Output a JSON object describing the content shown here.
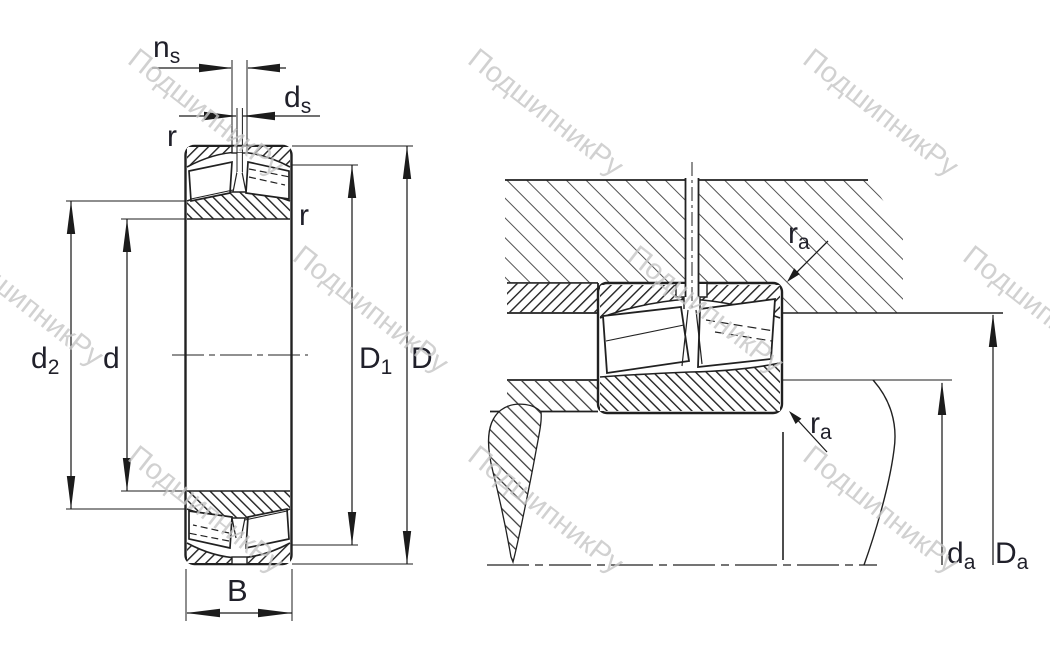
{
  "watermark": {
    "text": "ПодшипникРу"
  },
  "left_view": {
    "description": "spherical roller bearing axial cross-section",
    "labels": {
      "ns": {
        "main": "n",
        "sub": "s"
      },
      "ds": {
        "main": "d",
        "sub": "s"
      },
      "r_top_left": "r",
      "r_top_right": "r",
      "d2": {
        "main": "d",
        "sub": "2"
      },
      "d": {
        "main": "d"
      },
      "D1": {
        "main": "D",
        "sub": "1"
      },
      "D": {
        "main": "D"
      },
      "B": {
        "main": "B"
      }
    }
  },
  "right_view": {
    "description": "bearing mounted in housing on shaft with abutment dimensions",
    "labels": {
      "ra_top": {
        "main": "r",
        "sub": "a"
      },
      "ra_bottom": {
        "main": "r",
        "sub": "a"
      },
      "da": {
        "main": "d",
        "sub": "a"
      },
      "Da": {
        "main": "D",
        "sub": "a"
      }
    }
  },
  "colors": {
    "line": "#212121",
    "label": "#20202a",
    "watermark": "#c6c6c6",
    "background": "#ffffff"
  }
}
